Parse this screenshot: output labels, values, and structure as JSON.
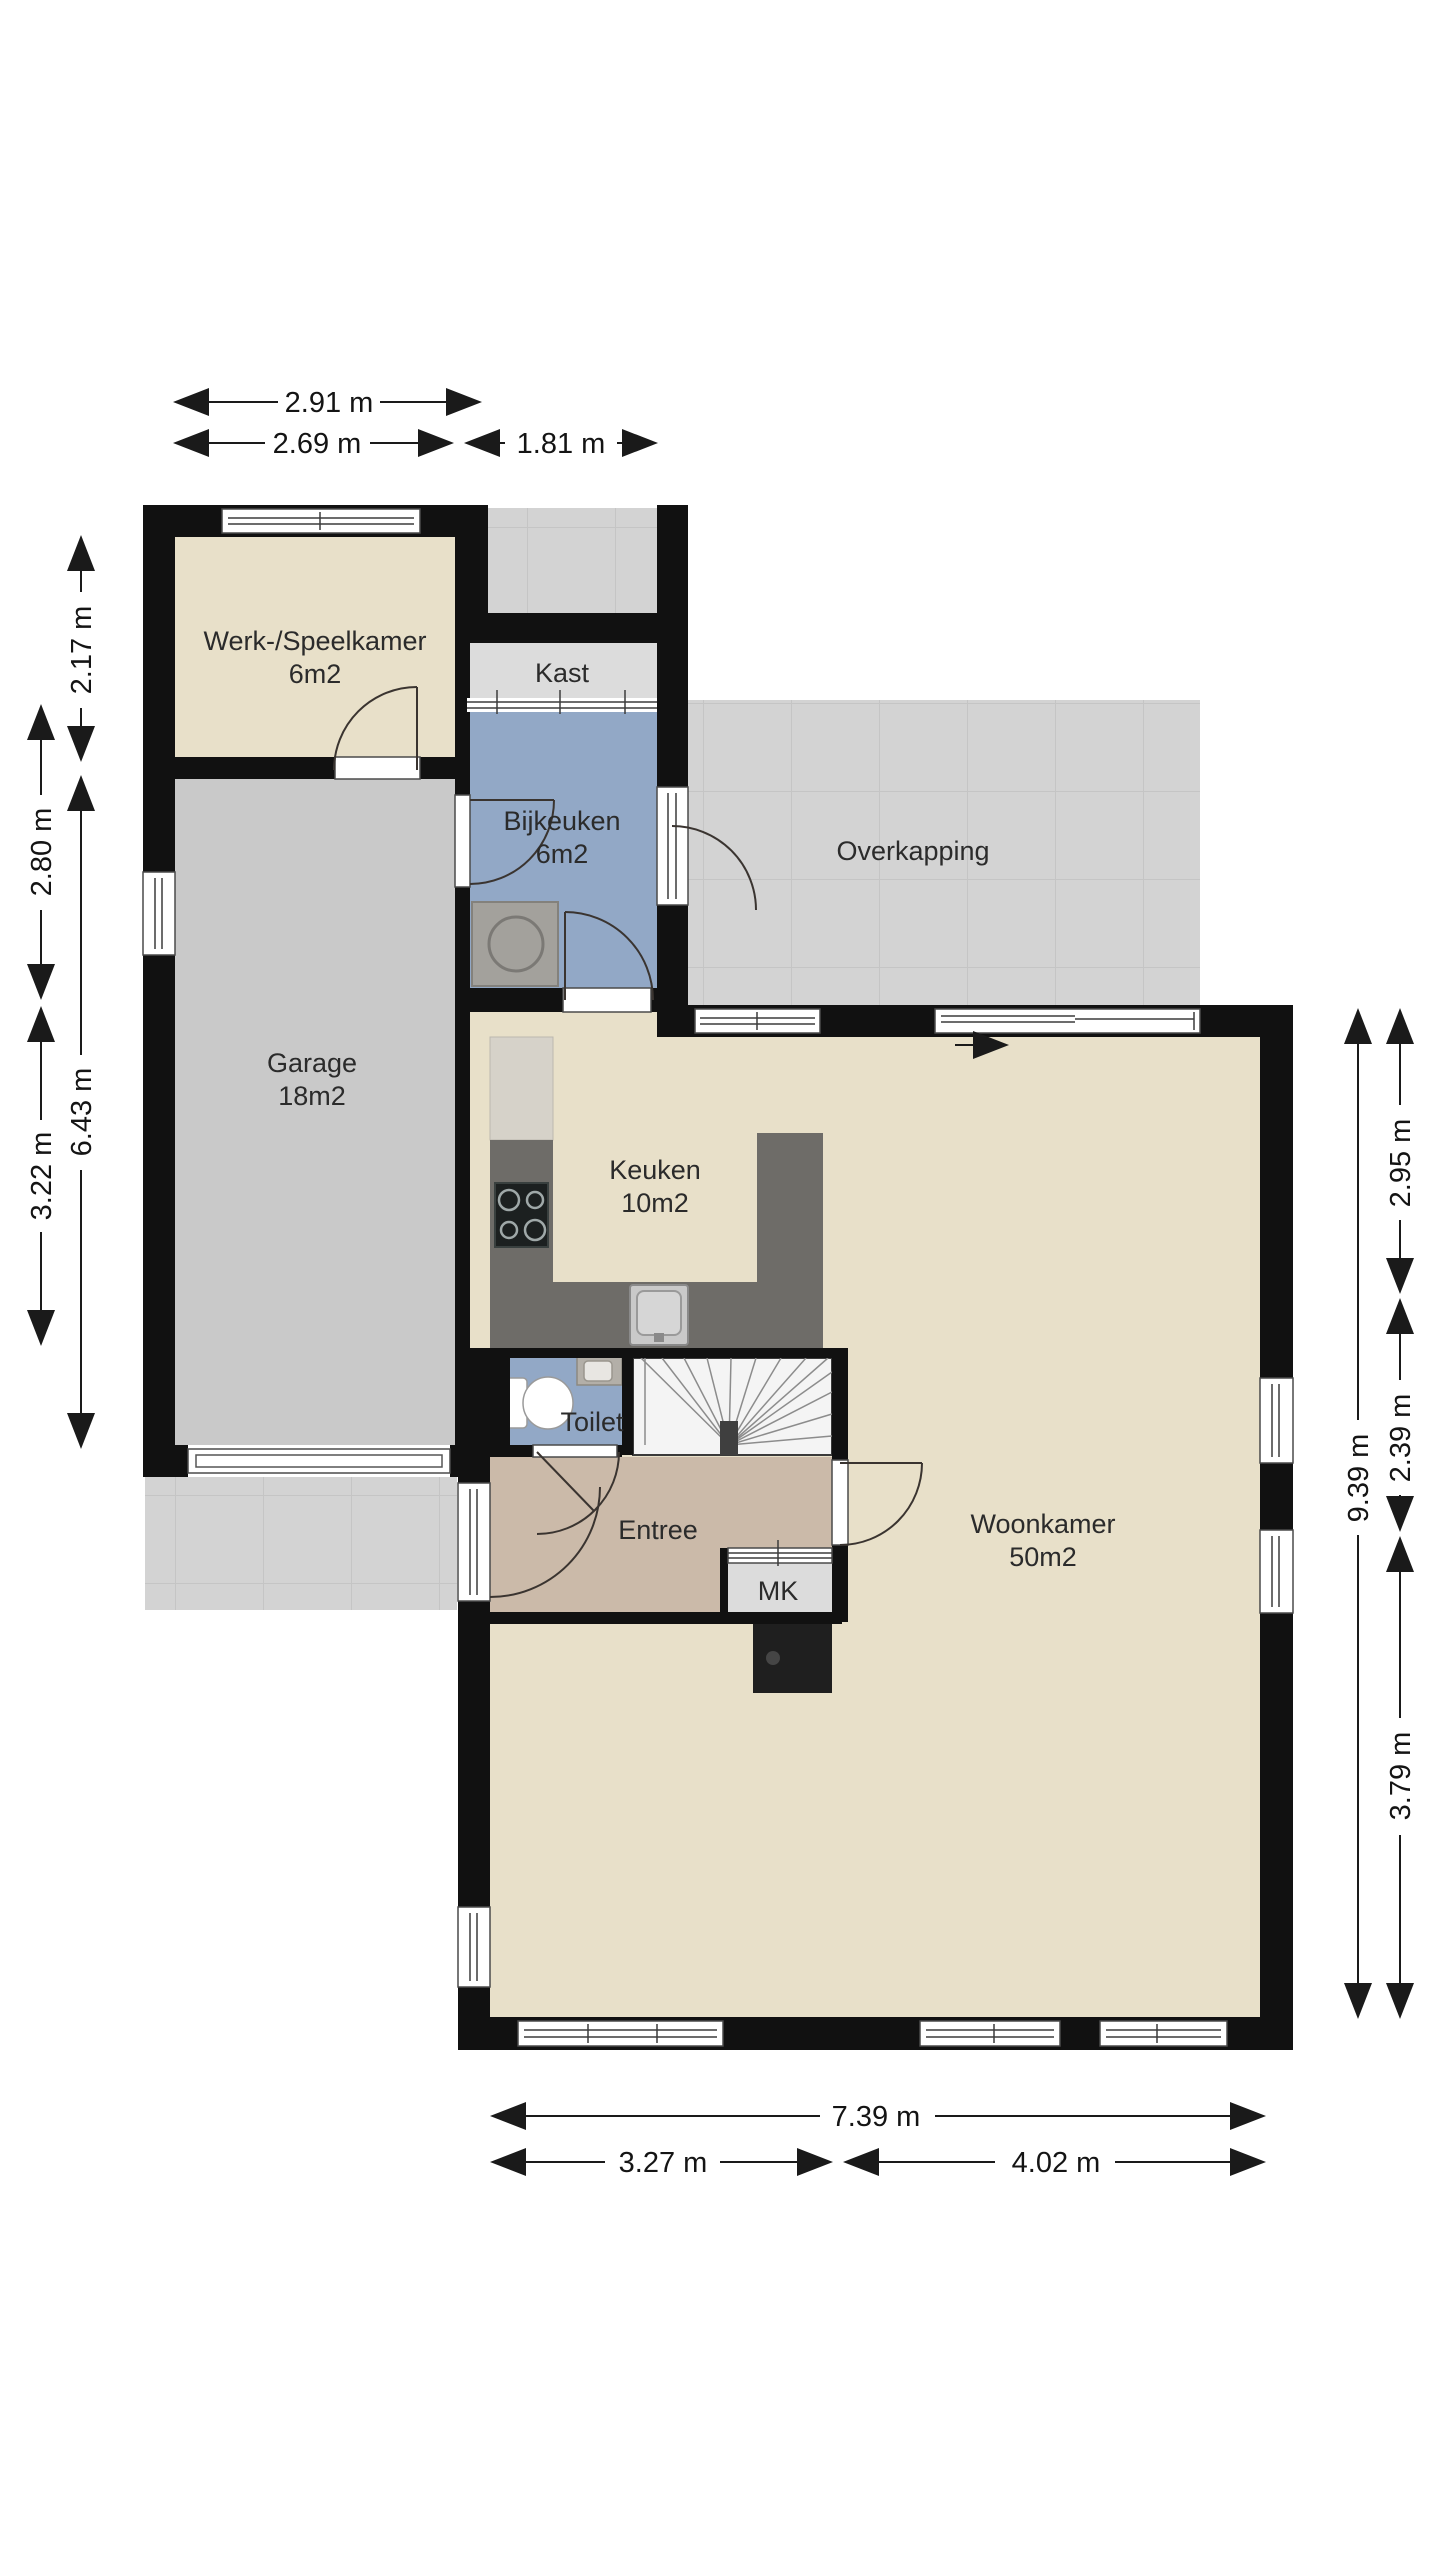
{
  "plan": {
    "type": "floorplan",
    "rooms": [
      {
        "id": "werkkamer",
        "name": "Werk-/Speelkamer",
        "area": "6m2"
      },
      {
        "id": "kast",
        "name": "Kast",
        "area": ""
      },
      {
        "id": "bijkeuken",
        "name": "Bijkeuken",
        "area": "6m2"
      },
      {
        "id": "overkapping",
        "name": "Overkapping",
        "area": ""
      },
      {
        "id": "garage",
        "name": "Garage",
        "area": "18m2"
      },
      {
        "id": "keuken",
        "name": "Keuken",
        "area": "10m2"
      },
      {
        "id": "toilet",
        "name": "Toilet",
        "area": ""
      },
      {
        "id": "entree",
        "name": "Entree",
        "area": ""
      },
      {
        "id": "mk",
        "name": "MK",
        "area": ""
      },
      {
        "id": "woonkamer",
        "name": "Woonkamer",
        "area": "50m2"
      }
    ],
    "dimensions": {
      "top": [
        {
          "label": "2.91 m"
        },
        {
          "label": "2.69 m"
        },
        {
          "label": "1.81 m"
        }
      ],
      "left": [
        {
          "label": "2.17 m"
        },
        {
          "label": "2.80 m"
        },
        {
          "label": "6.43 m"
        },
        {
          "label": "3.22 m"
        }
      ],
      "right": [
        {
          "label": "2.95 m"
        },
        {
          "label": "2.39 m"
        },
        {
          "label": "9.39 m"
        },
        {
          "label": "3.79 m"
        }
      ],
      "bottom": [
        {
          "label": "7.39 m"
        },
        {
          "label": "3.27 m"
        },
        {
          "label": "4.02 m"
        }
      ]
    },
    "colors": {
      "wall": "#111111",
      "floor_cream": "#e8e0c9",
      "floor_garage": "#c9c9c9",
      "floor_blue": "#92a8c6",
      "floor_entree": "#cbbaa9",
      "floor_closet": "#dcdcdc",
      "tiles": "#d3d3d3",
      "counter": "#6e6c68",
      "dimension": "#1a1a1a"
    }
  }
}
